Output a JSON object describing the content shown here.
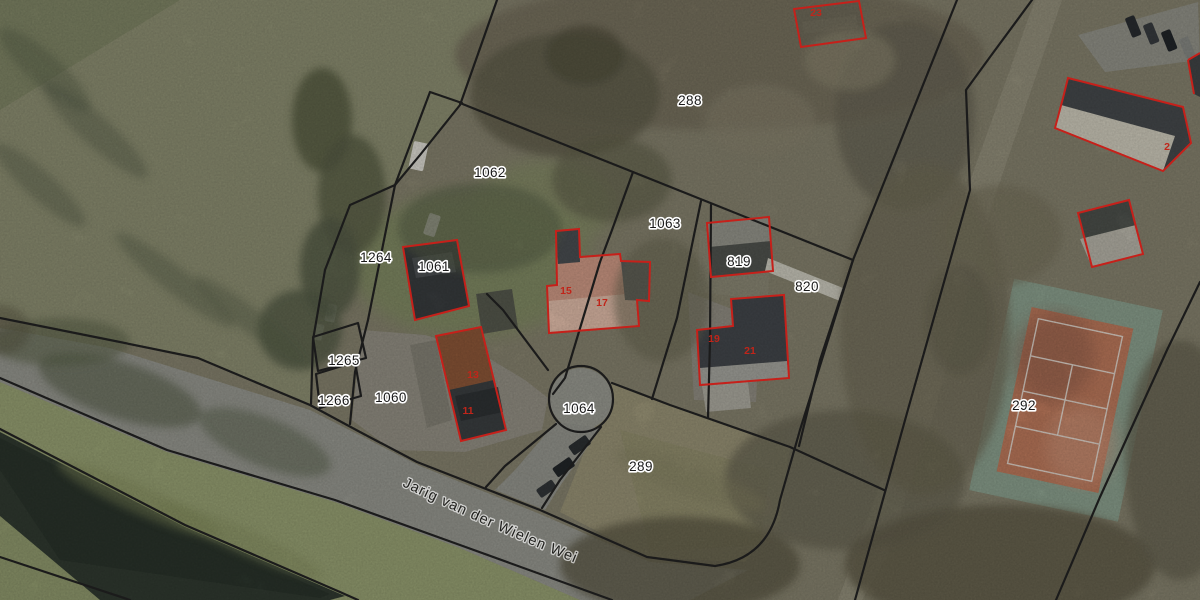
{
  "map": {
    "street_label": "Jarig van der Wielen Wei",
    "parcel_labels": [
      {
        "text": "288",
        "x": 690,
        "y": 101
      },
      {
        "text": "1062",
        "x": 490,
        "y": 173
      },
      {
        "text": "1063",
        "x": 665,
        "y": 224
      },
      {
        "text": "819",
        "x": 739,
        "y": 262
      },
      {
        "text": "820",
        "x": 807,
        "y": 287
      },
      {
        "text": "1264",
        "x": 376,
        "y": 258
      },
      {
        "text": "1061",
        "x": 434,
        "y": 267
      },
      {
        "text": "1265",
        "x": 344,
        "y": 361
      },
      {
        "text": "1266",
        "x": 334,
        "y": 401
      },
      {
        "text": "1060",
        "x": 391,
        "y": 398
      },
      {
        "text": "1064",
        "x": 579,
        "y": 409
      },
      {
        "text": "289",
        "x": 641,
        "y": 467
      },
      {
        "text": "292",
        "x": 1024,
        "y": 406
      }
    ],
    "house_numbers": [
      {
        "text": "23",
        "x": 816,
        "y": 12
      },
      {
        "text": "15",
        "x": 566,
        "y": 290
      },
      {
        "text": "17",
        "x": 602,
        "y": 302
      },
      {
        "text": "13",
        "x": 473,
        "y": 374
      },
      {
        "text": "11",
        "x": 468,
        "y": 410
      },
      {
        "text": "19",
        "x": 714,
        "y": 338
      },
      {
        "text": "21",
        "x": 750,
        "y": 350
      },
      {
        "text": "2",
        "x": 1167,
        "y": 146
      }
    ],
    "colors": {
      "parcel_boundary": "#1b1b1b",
      "building_outline": "#c6201a",
      "label_text": "#191919",
      "label_halo": "#ffffff",
      "house_number": "#c0251a",
      "road": "#9e9f97",
      "water": "#333d33",
      "field_green": "#97a173",
      "scrub": "#8d8974",
      "tennis_court": "#c67f60",
      "tennis_surround": "#87a18c"
    }
  }
}
